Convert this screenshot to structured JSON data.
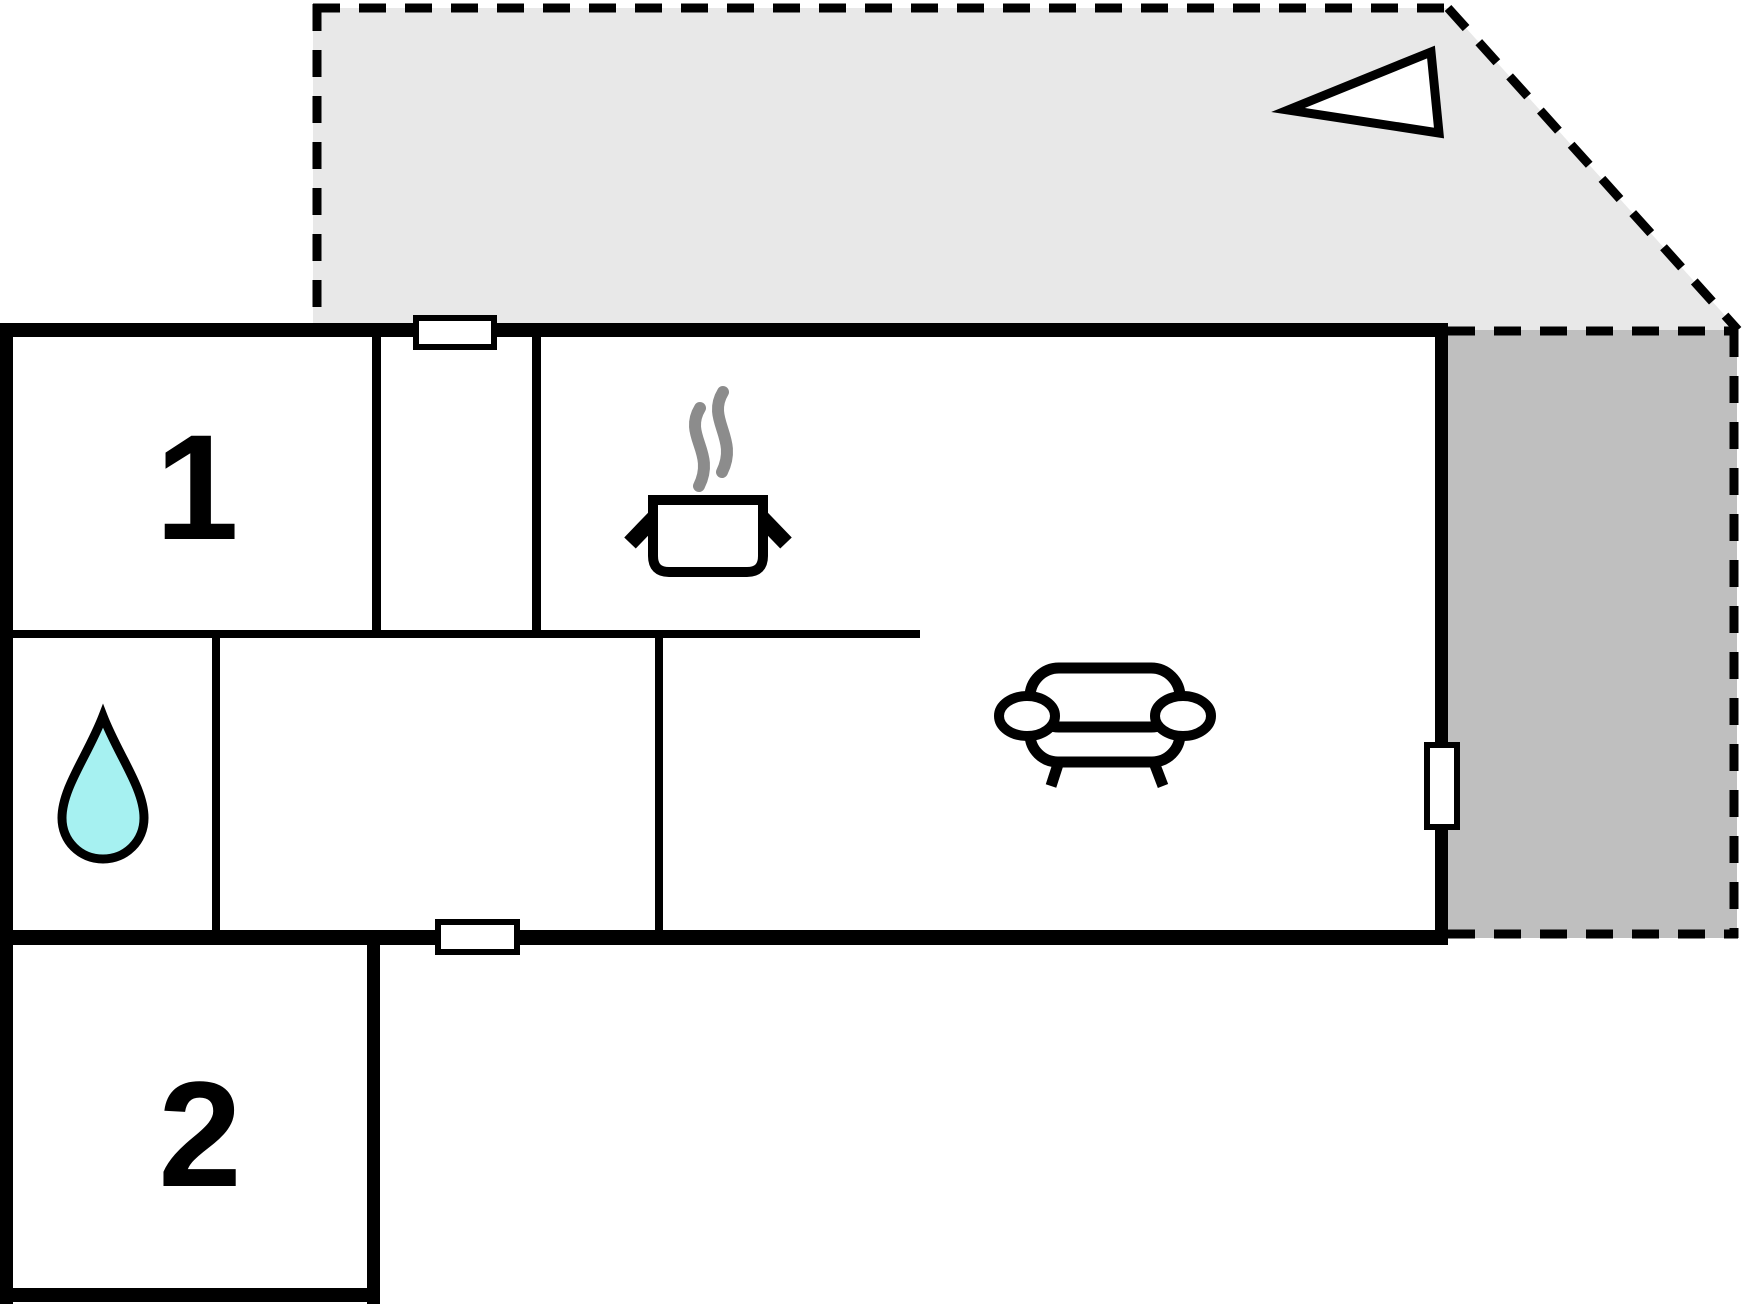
{
  "floorplan": {
    "rooms": [
      {
        "id": "bedroom-1",
        "label": "1"
      },
      {
        "id": "bedroom-2",
        "label": "2"
      }
    ],
    "colors": {
      "terrace_light": "#e8e8e8",
      "terrace_dark": "#bfbfbf",
      "water_drop": "#a6f1f1",
      "steam": "#8c8c8c",
      "wall": "#000000",
      "background": "#ffffff"
    },
    "icons": {
      "north_arrow": "north-arrow",
      "water_drop": "water-drop-icon",
      "cooking_pot": "cooking-pot-icon",
      "sofa": "sofa-icon",
      "window_marker": "window-marker",
      "door_marker": "door-marker"
    }
  }
}
